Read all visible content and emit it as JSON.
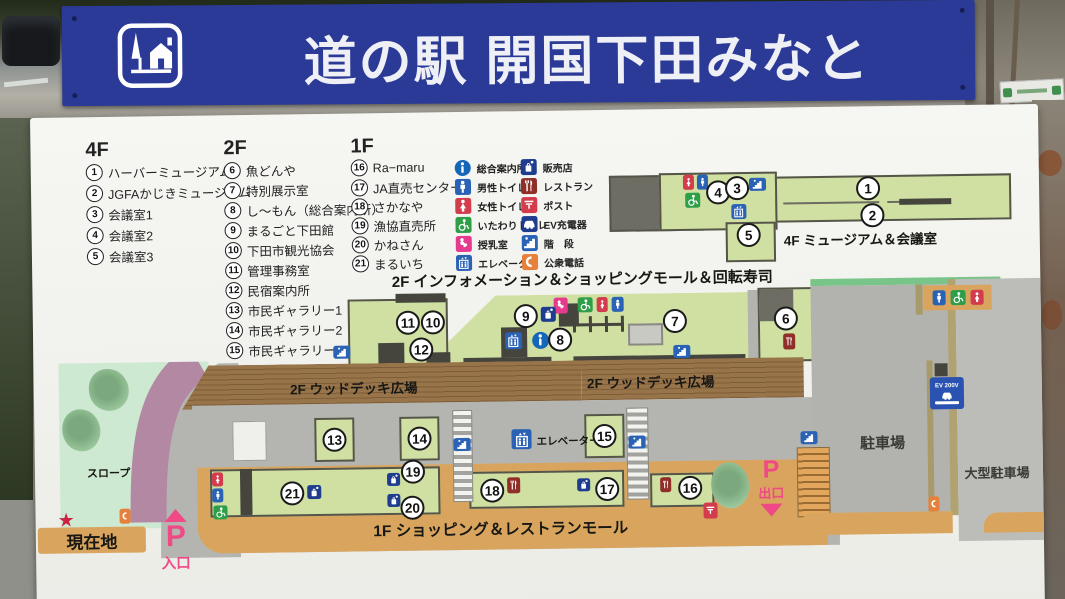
{
  "banner": {
    "title": "道の駅 開国下田みなと"
  },
  "legend": {
    "floors": [
      {
        "name": "4F",
        "items": [
          {
            "n": "1",
            "label": "ハーバーミュージアム"
          },
          {
            "n": "2",
            "label": "JGFAかじきミュージアム"
          },
          {
            "n": "3",
            "label": "会議室1"
          },
          {
            "n": "4",
            "label": "会議室2"
          },
          {
            "n": "5",
            "label": "会議室3"
          }
        ]
      },
      {
        "name": "2F",
        "items": [
          {
            "n": "6",
            "label": "魚どんや"
          },
          {
            "n": "7",
            "label": "特別展示室"
          },
          {
            "n": "8",
            "label": "し～もん（総合案内所）"
          },
          {
            "n": "9",
            "label": "まるごと下田館"
          },
          {
            "n": "10",
            "label": "下田市観光協会"
          },
          {
            "n": "11",
            "label": "管理事務室"
          },
          {
            "n": "12",
            "label": "民宿案内所"
          },
          {
            "n": "13",
            "label": "市民ギャラリー1"
          },
          {
            "n": "14",
            "label": "市民ギャラリー2"
          },
          {
            "n": "15",
            "label": "市民ギャラリー3"
          }
        ]
      },
      {
        "name": "1F",
        "items": [
          {
            "n": "16",
            "label": "Ra−maru"
          },
          {
            "n": "17",
            "label": "JA直売センター"
          },
          {
            "n": "18",
            "label": "さかなや"
          },
          {
            "n": "19",
            "label": "漁協直売所"
          },
          {
            "n": "20",
            "label": "かねさん"
          },
          {
            "n": "21",
            "label": "まるいち"
          }
        ]
      }
    ],
    "icons": [
      {
        "icon": "info",
        "label": "総合案内所"
      },
      {
        "icon": "male-toilet",
        "label": "男性トイレ"
      },
      {
        "icon": "female-toilet",
        "label": "女性トイレ"
      },
      {
        "icon": "accessible-toilet",
        "label": "いたわりトイレ"
      },
      {
        "icon": "nursing-room",
        "label": "授乳室"
      },
      {
        "icon": "elevator",
        "label": "エレベーター"
      },
      {
        "icon": "shop",
        "label": "販売店"
      },
      {
        "icon": "restaurant",
        "label": "レストラン"
      },
      {
        "icon": "post",
        "label": "ポスト"
      },
      {
        "icon": "ev-charger",
        "label": "EV充電器"
      },
      {
        "icon": "stairs",
        "label": "階　段"
      },
      {
        "icon": "payphone",
        "label": "公衆電話"
      }
    ]
  },
  "map": {
    "floor4_label": "4F ミュージアム＆会議室",
    "floor2_label": "2F インフォメーション＆ショッピングモール＆回転寿司",
    "deck_label_left": "2F ウッドデッキ広場",
    "deck_label_right": "2F ウッドデッキ広場",
    "floor1_label": "1F ショッピング＆レストランモール",
    "elevator_label": "エレベーター",
    "slope_label": "スロープ",
    "here_label": "現在地",
    "here_star": "★",
    "entrance": {
      "p": "P",
      "label": "入口"
    },
    "exit": {
      "p": "P",
      "label": "出口"
    },
    "parking_label": "駐車場",
    "large_parking_label": "大型駐車場",
    "ev_sign": "EV 200V"
  },
  "colors": {
    "banner_blue": "#2b3a96",
    "building_green": "#cfe0a2",
    "deck_brown": "#8f6d42",
    "walkway_tan": "#d9a55e",
    "slope_purple": "#b288a3",
    "parking_gray": "#b2b3af",
    "accent_pink": "#ef4a86"
  }
}
